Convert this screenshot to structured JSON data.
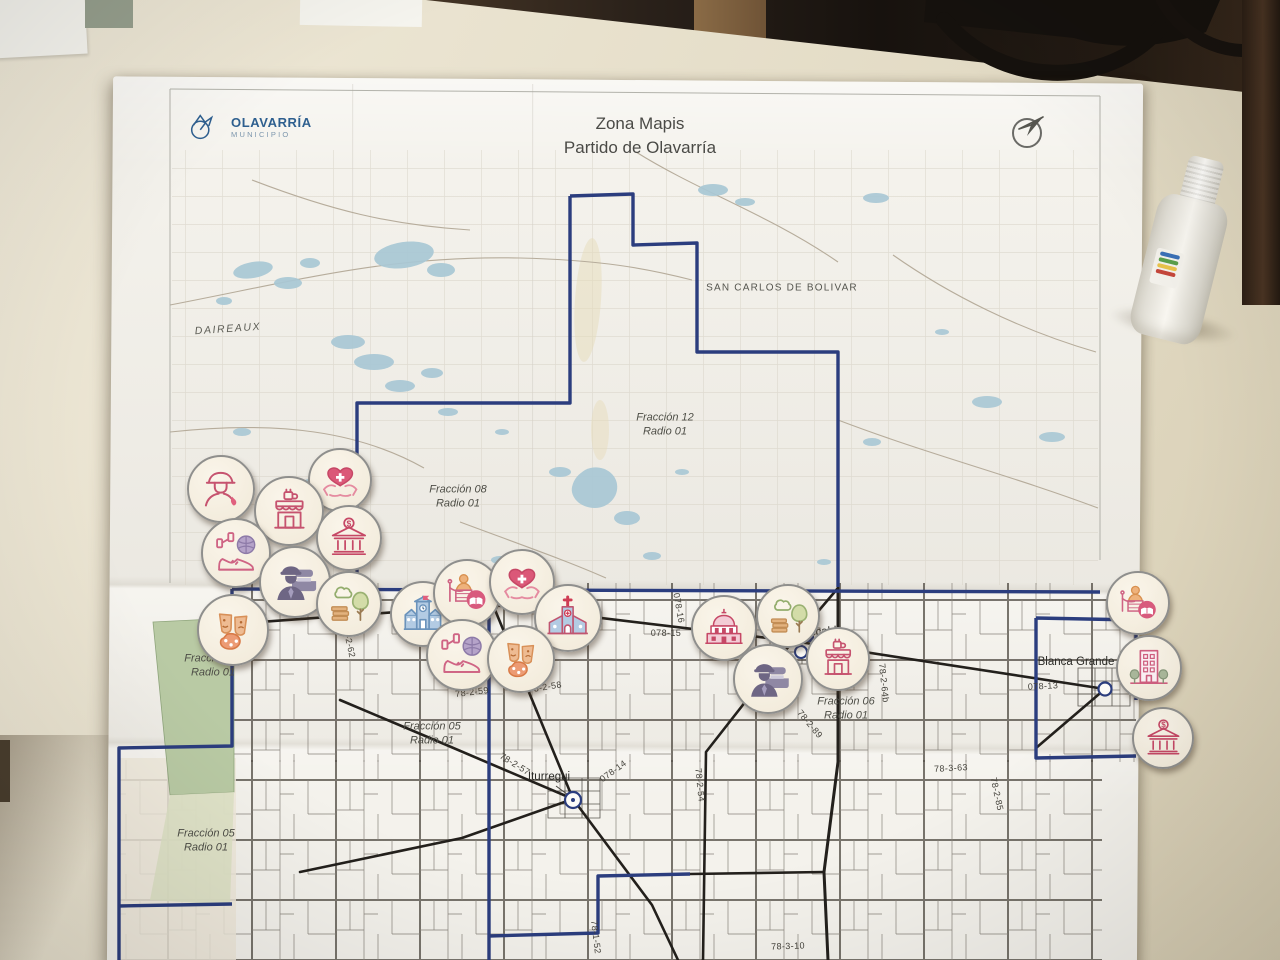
{
  "header": {
    "logo_title": "OLAVARRÍA",
    "logo_subtitle": "MUNICIPIO",
    "title_line1": "Zona Mapis",
    "title_line2": "Partido de Olavarría"
  },
  "map": {
    "places": [
      {
        "text": "DAIREAUX",
        "x": 228,
        "y": 329,
        "rot": -4,
        "cls": "place"
      },
      {
        "text": "SAN CARLOS DE BOLIVAR",
        "x": 782,
        "y": 288,
        "rot": 0,
        "cls": "place-caps"
      },
      {
        "text": "Iturregui",
        "x": 549,
        "y": 777,
        "rot": 0,
        "cls": "town"
      },
      {
        "text": "Recalde",
        "x": 822,
        "y": 632,
        "rot": -4,
        "cls": "town"
      },
      {
        "text": "Blanca Grande",
        "x": 1076,
        "y": 662,
        "rot": 0,
        "cls": "town"
      }
    ],
    "fractions": [
      {
        "line1": "Fracción 12",
        "line2": "Radio 01",
        "x": 665,
        "y": 425
      },
      {
        "line1": "Fracción 08",
        "line2": "Radio 01",
        "x": 458,
        "y": 497
      },
      {
        "line1": "Fracción 01",
        "line2": "Radio 01",
        "x": 213,
        "y": 666
      },
      {
        "line1": "Fracción 05",
        "line2": "Radio 01",
        "x": 432,
        "y": 734
      },
      {
        "line1": "Fracción 05",
        "line2": "Radio 01",
        "x": 206,
        "y": 841
      },
      {
        "line1": "Fracción 06",
        "line2": "Radio 01",
        "x": 846,
        "y": 709
      }
    ],
    "parcel_codes": [
      {
        "text": "78-2-62",
        "x": 349,
        "y": 641,
        "rot": 78
      },
      {
        "text": "078-16",
        "x": 679,
        "y": 608,
        "rot": 80
      },
      {
        "text": "078-15",
        "x": 666,
        "y": 633,
        "rot": 0
      },
      {
        "text": "78-2-59",
        "x": 472,
        "y": 692,
        "rot": -7
      },
      {
        "text": "78-2-58",
        "x": 545,
        "y": 687,
        "rot": -9
      },
      {
        "text": "78-2-57",
        "x": 515,
        "y": 764,
        "rot": 32
      },
      {
        "text": "078-14",
        "x": 613,
        "y": 771,
        "rot": -36
      },
      {
        "text": "078-13",
        "x": 1043,
        "y": 686,
        "rot": -3
      },
      {
        "text": "78-1-52",
        "x": 596,
        "y": 937,
        "rot": 83
      },
      {
        "text": "78-2-54",
        "x": 700,
        "y": 785,
        "rot": 84
      },
      {
        "text": "78-3-63",
        "x": 951,
        "y": 768,
        "rot": -3
      },
      {
        "text": "78-2-85",
        "x": 997,
        "y": 794,
        "rot": 78
      },
      {
        "text": "78-2-89",
        "x": 810,
        "y": 724,
        "rot": 50
      },
      {
        "text": "78-2-64b",
        "x": 884,
        "y": 683,
        "rot": 84
      },
      {
        "text": "78-3-10",
        "x": 788,
        "y": 946,
        "rot": -2
      }
    ]
  },
  "stickers": [
    {
      "icon": "firefighter-icon",
      "x": 219,
      "y": 487,
      "d": 64
    },
    {
      "icon": "health-icon",
      "x": 338,
      "y": 478,
      "d": 60
    },
    {
      "icon": "cafe-icon",
      "x": 287,
      "y": 509,
      "d": 66
    },
    {
      "icon": "bank-icon",
      "x": 347,
      "y": 536,
      "d": 62
    },
    {
      "icon": "sports-icon",
      "x": 234,
      "y": 551,
      "d": 66
    },
    {
      "icon": "police-icon",
      "x": 293,
      "y": 580,
      "d": 68
    },
    {
      "icon": "park-icon",
      "x": 347,
      "y": 602,
      "d": 62
    },
    {
      "icon": "culture-icon",
      "x": 231,
      "y": 628,
      "d": 68
    },
    {
      "icon": "school-icon",
      "x": 421,
      "y": 612,
      "d": 62
    },
    {
      "icon": "museum-icon",
      "x": 465,
      "y": 591,
      "d": 64
    },
    {
      "icon": "health-icon",
      "x": 520,
      "y": 580,
      "d": 62
    },
    {
      "icon": "church-icon",
      "x": 566,
      "y": 616,
      "d": 64
    },
    {
      "icon": "sports-icon",
      "x": 460,
      "y": 653,
      "d": 68
    },
    {
      "icon": "culture-icon",
      "x": 519,
      "y": 657,
      "d": 64
    },
    {
      "icon": "government-icon",
      "x": 722,
      "y": 626,
      "d": 62
    },
    {
      "icon": "park-icon",
      "x": 786,
      "y": 614,
      "d": 60
    },
    {
      "icon": "police-icon",
      "x": 766,
      "y": 677,
      "d": 66
    },
    {
      "icon": "cafe-icon",
      "x": 836,
      "y": 657,
      "d": 60
    },
    {
      "icon": "museum-icon",
      "x": 1136,
      "y": 601,
      "d": 60
    },
    {
      "icon": "city-building-icon",
      "x": 1147,
      "y": 666,
      "d": 62
    },
    {
      "icon": "bank-icon",
      "x": 1161,
      "y": 736,
      "d": 58
    }
  ],
  "colors": {
    "boundary_navy": "#2b3d7e",
    "road_black": "#23201c",
    "lake_blue": "#a9c8d5",
    "green_zone": "#b9caa4",
    "sticker_pink": "#c6536f",
    "logo_blue": "#2e5f8f"
  }
}
